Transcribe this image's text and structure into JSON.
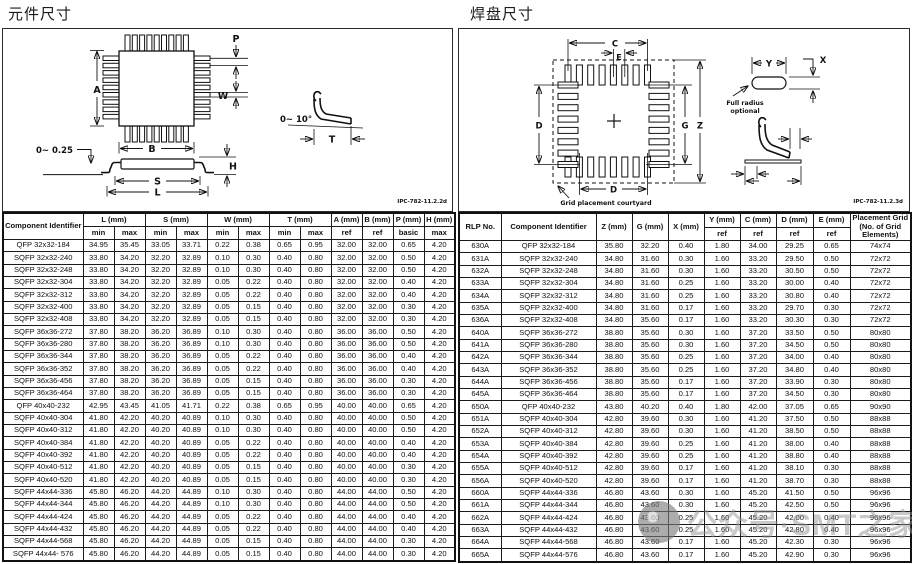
{
  "left": {
    "title": "元件尺寸",
    "drawing": {
      "a": "A",
      "b": "B",
      "p": "P",
      "w": "W",
      "s": "S",
      "l": "L",
      "h": "H",
      "t": "T",
      "standoff": "0~ 0.25",
      "lead_angle": "0~ 10°",
      "ipc": "IPC-782-11.2.2d"
    },
    "table": {
      "header": {
        "component": "Component Identifier",
        "l": "L (mm)",
        "s": "S (mm)",
        "w": "W (mm)",
        "t": "T (mm)",
        "a": "A (mm)",
        "b": "B (mm)",
        "p": "P (mm)",
        "h": "H (mm)",
        "min": "min",
        "max": "max",
        "ref": "ref",
        "basic": "basic"
      },
      "rows": [
        [
          "QFP 32x32-184",
          "34.95",
          "35.45",
          "33.05",
          "33.71",
          "0.22",
          "0.38",
          "0.65",
          "0.95",
          "32.00",
          "32.00",
          "0.65",
          "4.20"
        ],
        [
          "SQFP 32x32-240",
          "33.80",
          "34.20",
          "32.20",
          "32.89",
          "0.10",
          "0.30",
          "0.40",
          "0.80",
          "32.00",
          "32.00",
          "0.50",
          "4.20"
        ],
        [
          "SQFP 32x32-248",
          "33.80",
          "34.20",
          "32.20",
          "32.89",
          "0.10",
          "0.30",
          "0.40",
          "0.80",
          "32.00",
          "32.00",
          "0.50",
          "4.20"
        ],
        [
          "SQFP 32x32-304",
          "33.80",
          "34.20",
          "32.20",
          "32.89",
          "0.05",
          "0.22",
          "0.40",
          "0.80",
          "32.00",
          "32.00",
          "0.40",
          "4.20"
        ],
        [
          "SQFP 32x32-312",
          "33.80",
          "34.20",
          "32.20",
          "32.89",
          "0.05",
          "0.22",
          "0.40",
          "0.80",
          "32.00",
          "32.00",
          "0.40",
          "4.20"
        ],
        [
          "SQFP 32x32-400",
          "33.80",
          "34.20",
          "32.20",
          "32.89",
          "0.05",
          "0.15",
          "0.40",
          "0.80",
          "32.00",
          "32.00",
          "0.30",
          "4.20"
        ],
        [
          "SQFP 32x32-408",
          "33.80",
          "34.20",
          "32.20",
          "32.89",
          "0.05",
          "0.15",
          "0.40",
          "0.80",
          "32.00",
          "32.00",
          "0.30",
          "4.20"
        ],
        [
          "SQFP 36x36-272",
          "37.80",
          "38.20",
          "36.20",
          "36.89",
          "0.10",
          "0.30",
          "0.40",
          "0.80",
          "36.00",
          "36.00",
          "0.50",
          "4.20"
        ],
        [
          "SQFP 36x36-280",
          "37.80",
          "38.20",
          "36.20",
          "36.89",
          "0.10",
          "0.30",
          "0.40",
          "0.80",
          "36.00",
          "36.00",
          "0.50",
          "4.20"
        ],
        [
          "SQFP 36x36-344",
          "37.80",
          "38.20",
          "36.20",
          "36.89",
          "0.05",
          "0.22",
          "0.40",
          "0.80",
          "36.00",
          "36.00",
          "0.40",
          "4.20"
        ],
        [
          "SQFP 36x36-352",
          "37.80",
          "38.20",
          "36.20",
          "36.89",
          "0.05",
          "0.22",
          "0.40",
          "0.80",
          "36.00",
          "36.00",
          "0.40",
          "4.20"
        ],
        [
          "SQFP 36x36-456",
          "37.80",
          "38.20",
          "36.20",
          "36.89",
          "0.05",
          "0.15",
          "0.40",
          "0.80",
          "36.00",
          "36.00",
          "0.30",
          "4.20"
        ],
        [
          "SQFP 36x36-464",
          "37.80",
          "38.20",
          "36.20",
          "36.89",
          "0.05",
          "0.15",
          "0.40",
          "0.80",
          "36.00",
          "36.00",
          "0.30",
          "4.20"
        ],
        [
          "QFP 40x40-232",
          "42.95",
          "43.45",
          "41.05",
          "41.71",
          "0.22",
          "0.38",
          "0.65",
          "0.95",
          "40.00",
          "40.00",
          "0.65",
          "4.20"
        ],
        [
          "SQFP 40x40-304",
          "41.80",
          "42.20",
          "40.20",
          "40.89",
          "0.10",
          "0.30",
          "0.40",
          "0.80",
          "40.00",
          "40.00",
          "0.50",
          "4.20"
        ],
        [
          "SQFP 40x40-312",
          "41.80",
          "42.20",
          "40.20",
          "40.89",
          "0.10",
          "0.30",
          "0.40",
          "0.80",
          "40.00",
          "40.00",
          "0.50",
          "4.20"
        ],
        [
          "SQFP 40x40-384",
          "41.80",
          "42.20",
          "40.20",
          "40.89",
          "0.05",
          "0.22",
          "0.40",
          "0.80",
          "40.00",
          "40.00",
          "0.40",
          "4.20"
        ],
        [
          "SQFP 40x40-392",
          "41.80",
          "42.20",
          "40.20",
          "40.89",
          "0.05",
          "0.22",
          "0.40",
          "0.80",
          "40.00",
          "40.00",
          "0.40",
          "4.20"
        ],
        [
          "SQFP 40x40-512",
          "41.80",
          "42.20",
          "40.20",
          "40.89",
          "0.05",
          "0.15",
          "0.40",
          "0.80",
          "40.00",
          "40.00",
          "0.30",
          "4.20"
        ],
        [
          "SQFP 40x40-520",
          "41.80",
          "42.20",
          "40.20",
          "40.89",
          "0.05",
          "0.15",
          "0.40",
          "0.80",
          "40.00",
          "40.00",
          "0.30",
          "4.20"
        ],
        [
          "SQFP 44x44-336",
          "45.80",
          "46.20",
          "44.20",
          "44.89",
          "0.10",
          "0.30",
          "0.40",
          "0.80",
          "44.00",
          "44.00",
          "0.50",
          "4.20"
        ],
        [
          "SQFP 44x44-344",
          "45.80",
          "46.20",
          "44.20",
          "44.89",
          "0.10",
          "0.30",
          "0.40",
          "0.80",
          "44.00",
          "44.00",
          "0.50",
          "4.20"
        ],
        [
          "SQFP 44x44-424",
          "45.80",
          "46.20",
          "44.20",
          "44.89",
          "0.05",
          "0.22",
          "0.40",
          "0.80",
          "44.00",
          "44.00",
          "0.40",
          "4.20"
        ],
        [
          "SQFP 44x44-432",
          "45.80",
          "46.20",
          "44.20",
          "44.89",
          "0.05",
          "0.22",
          "0.40",
          "0.80",
          "44.00",
          "44.00",
          "0.40",
          "4.20"
        ],
        [
          "SQFP 44x44-568",
          "45.80",
          "46.20",
          "44.20",
          "44.89",
          "0.05",
          "0.15",
          "0.40",
          "0.80",
          "44.00",
          "44.00",
          "0.30",
          "4.20"
        ],
        [
          "SQFP 44x44- 576",
          "45.80",
          "46.20",
          "44.20",
          "44.89",
          "0.05",
          "0.15",
          "0.40",
          "0.80",
          "44.00",
          "44.00",
          "0.30",
          "4.20"
        ]
      ]
    }
  },
  "right": {
    "title": "焊盘尺寸",
    "drawing": {
      "c": "C",
      "e": "E",
      "d_side": "D",
      "d_bottom": "D",
      "g": "G",
      "z": "Z",
      "y": "Y",
      "x": "X",
      "full_radius_line1": "Full radius",
      "full_radius_line2": "optional",
      "courtyard": "Grid placement courtyard",
      "ipc": "IPC-782-11.2.3d"
    },
    "table": {
      "header": {
        "rlp": "RLP No.",
        "component": "Component Identifier",
        "z": "Z (mm)",
        "g": "G (mm)",
        "x": "X (mm)",
        "y": "Y (mm)",
        "c": "C (mm)",
        "d": "D (mm)",
        "e": "E (mm)",
        "grid": "Placement Grid (No. of Grid Elements)",
        "ref": "ref"
      },
      "rows": [
        [
          "630A",
          "QFP 32x32-184",
          "35.80",
          "32.20",
          "0.40",
          "1.80",
          "34.00",
          "29.25",
          "0.65",
          "74x74"
        ],
        [
          "631A",
          "SQFP 32x32-240",
          "34.80",
          "31.60",
          "0.30",
          "1.60",
          "33.20",
          "29.50",
          "0.50",
          "72x72"
        ],
        [
          "632A",
          "SQFP 32x32-248",
          "34.80",
          "31.60",
          "0.30",
          "1.60",
          "33.20",
          "30.50",
          "0.50",
          "72x72"
        ],
        [
          "633A",
          "SQFP 32x32-304",
          "34.80",
          "31.60",
          "0.25",
          "1.60",
          "33.20",
          "30.00",
          "0.40",
          "72x72"
        ],
        [
          "634A",
          "SQFP 32x32-312",
          "34.80",
          "31.60",
          "0.25",
          "1.60",
          "33.20",
          "30.80",
          "0.40",
          "72x72"
        ],
        [
          "635A",
          "SQFP 32x32-400",
          "34.80",
          "31.60",
          "0.17",
          "1.60",
          "33.20",
          "29.70",
          "0.30",
          "72x72"
        ],
        [
          "636A",
          "SQFP 32x32-408",
          "34.80",
          "35.60",
          "0.17",
          "1.60",
          "33.20",
          "30.30",
          "0.30",
          "72x72"
        ],
        [
          "640A",
          "SQFP 36x36-272",
          "38.80",
          "35.60",
          "0.30",
          "1.60",
          "37.20",
          "33.50",
          "0.50",
          "80x80"
        ],
        [
          "641A",
          "SQFP 36x36-280",
          "38.80",
          "35.60",
          "0.30",
          "1.60",
          "37.20",
          "34.50",
          "0.50",
          "80x80"
        ],
        [
          "642A",
          "SQFP 36x36-344",
          "38.80",
          "35.60",
          "0.25",
          "1.60",
          "37.20",
          "34.00",
          "0.40",
          "80x80"
        ],
        [
          "643A",
          "SQFP 36x36-352",
          "38.80",
          "35.60",
          "0.25",
          "1.60",
          "37.20",
          "34.80",
          "0.40",
          "80x80"
        ],
        [
          "644A",
          "SQFP 36x36-456",
          "38.80",
          "35.60",
          "0.17",
          "1.60",
          "37.20",
          "33.90",
          "0.30",
          "80x80"
        ],
        [
          "645A",
          "SQFP 36x36-464",
          "38.80",
          "35.60",
          "0.17",
          "1.60",
          "37.20",
          "34.50",
          "0.30",
          "80x80"
        ],
        [
          "650A",
          "QFP 40x40-232",
          "43.80",
          "40.20",
          "0.40",
          "1.80",
          "42.00",
          "37.05",
          "0.65",
          "90x90"
        ],
        [
          "651A",
          "SQFP 40x40-304",
          "42.80",
          "39.60",
          "0.30",
          "1.60",
          "41.20",
          "37.50",
          "0.50",
          "88x88"
        ],
        [
          "652A",
          "SQFP 40x40-312",
          "42.80",
          "39.60",
          "0.30",
          "1.60",
          "41.20",
          "38.50",
          "0.50",
          "88x88"
        ],
        [
          "653A",
          "SQFP 40x40-384",
          "42.80",
          "39.60",
          "0.25",
          "1.60",
          "41.20",
          "38.00",
          "0.40",
          "88x88"
        ],
        [
          "654A",
          "SQFP 40x40-392",
          "42.80",
          "39.60",
          "0.25",
          "1.60",
          "41.20",
          "38.80",
          "0.40",
          "88x88"
        ],
        [
          "655A",
          "SQFP 40x40-512",
          "42.80",
          "39.60",
          "0.17",
          "1.60",
          "41.20",
          "38.10",
          "0.30",
          "88x88"
        ],
        [
          "656A",
          "SQFP 40x40-520",
          "42.80",
          "39.60",
          "0.17",
          "1.60",
          "41.20",
          "38.70",
          "0.30",
          "88x88"
        ],
        [
          "660A",
          "SQFP 44x44-336",
          "46.80",
          "43.60",
          "0.30",
          "1.60",
          "45.20",
          "41.50",
          "0.50",
          "96x96"
        ],
        [
          "661A",
          "SQFP 44x44-344",
          "46.80",
          "43.60",
          "0.30",
          "1.60",
          "45.20",
          "42.50",
          "0.50",
          "96x96"
        ],
        [
          "662A",
          "SQFP 44x44-424",
          "46.80",
          "43.60",
          "0.25",
          "1.60",
          "45.20",
          "42.00",
          "0.40",
          "96x96"
        ],
        [
          "663A",
          "SQFP 44x44-432",
          "46.80",
          "43.60",
          "0.25",
          "1.60",
          "45.20",
          "42.80",
          "0.40",
          "96x96"
        ],
        [
          "664A",
          "SQFP 44x44-568",
          "46.80",
          "43.60",
          "0.17",
          "1.60",
          "45.20",
          "42.30",
          "0.30",
          "96x96"
        ],
        [
          "665A",
          "SQFP 44x44-576",
          "46.80",
          "43.60",
          "0.17",
          "1.60",
          "45.20",
          "42.90",
          "0.30",
          "96x96"
        ]
      ]
    }
  },
  "watermark": {
    "text": "公众号·SMT之家"
  }
}
